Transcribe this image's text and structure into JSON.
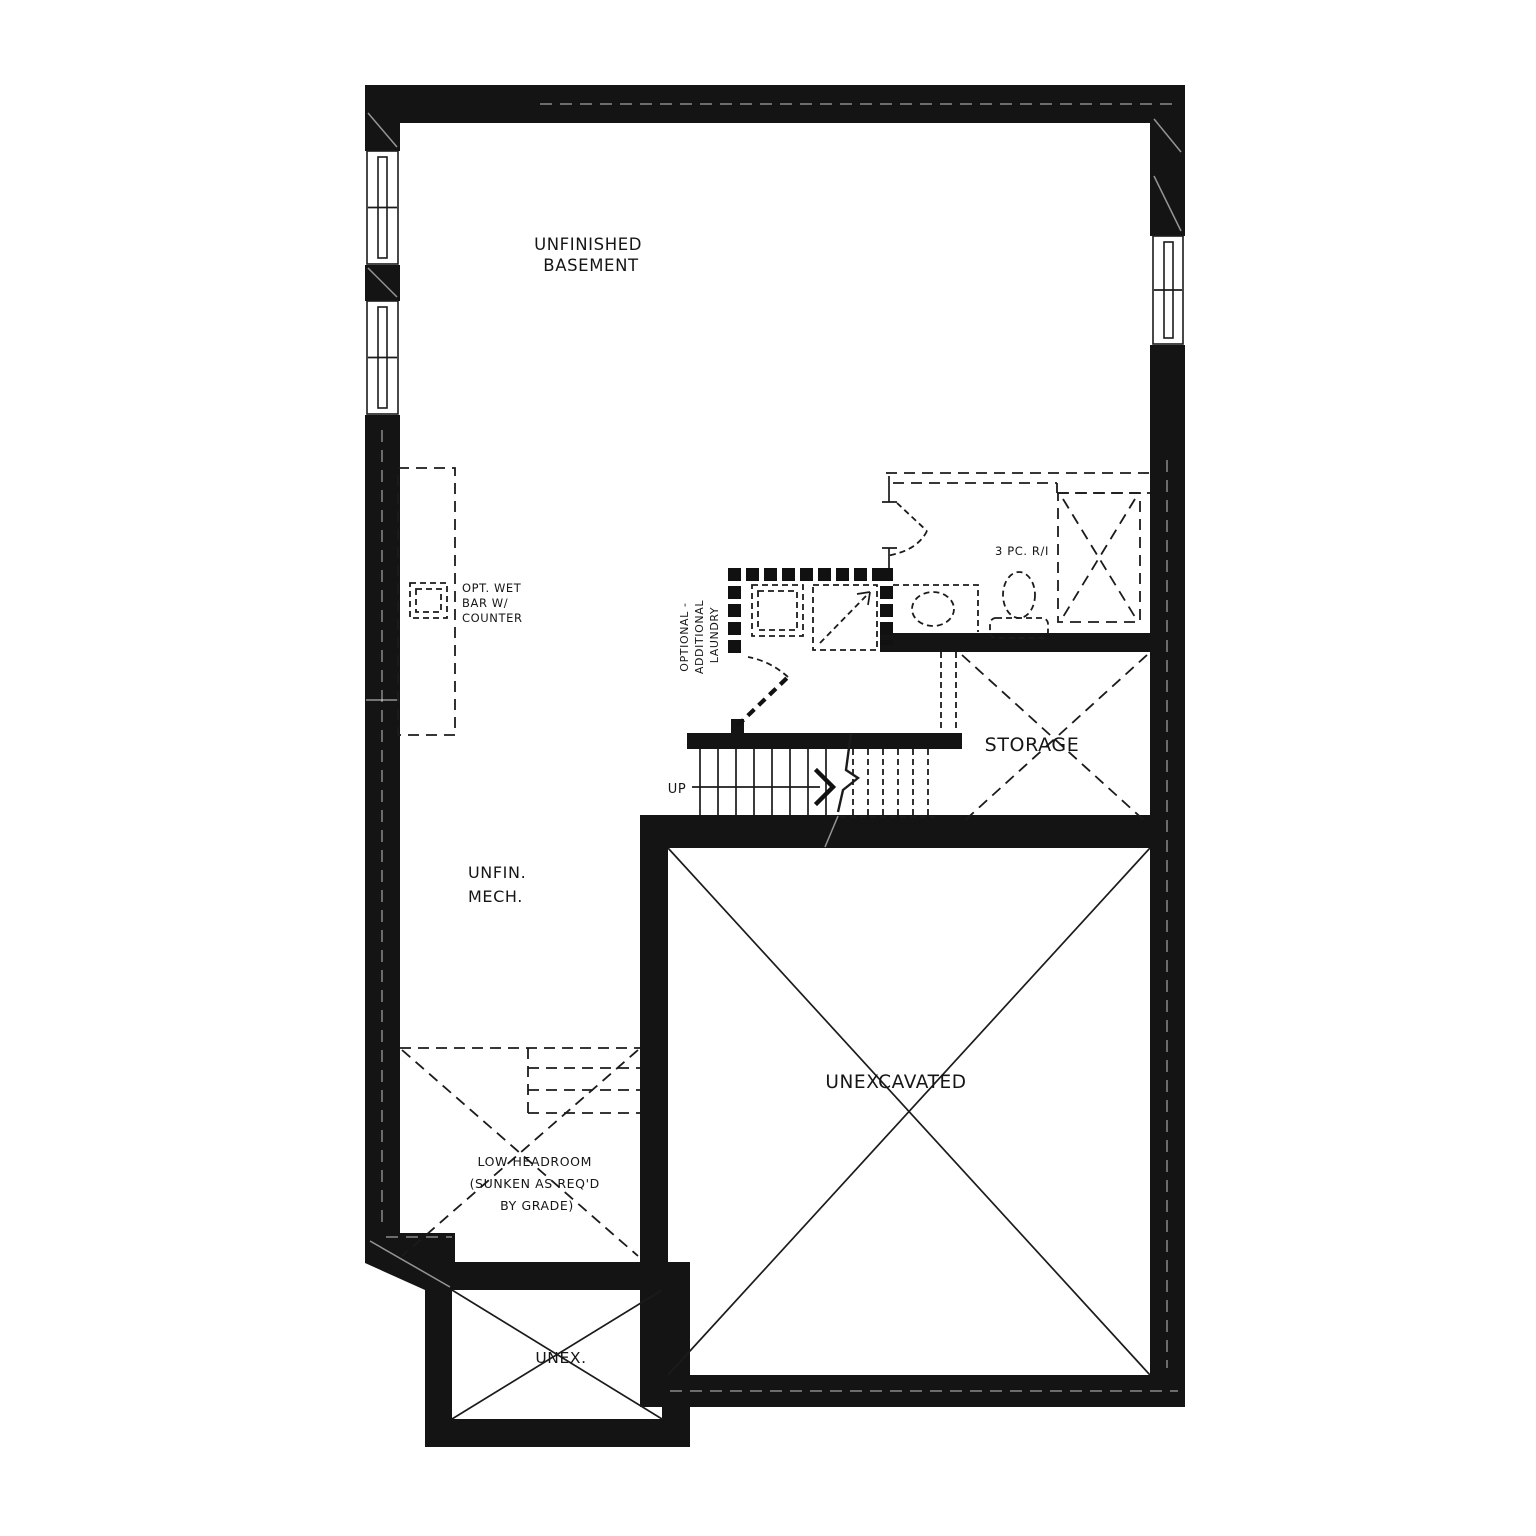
{
  "title": "Basement floor plan",
  "colors": {
    "wall": "#141414",
    "line": "#1b1b1b",
    "background": "#ffffff"
  },
  "labels": {
    "unfinished_basement": [
      "UNFINISHED",
      "BASEMENT"
    ],
    "wet_bar": [
      "OPT. WET",
      "BAR W/",
      "COUNTER"
    ],
    "optional_laundry": [
      "OPTIONAL -",
      "ADDITIONAL",
      "LAUNDRY"
    ],
    "bath_rough_in": "3 PC. R/I",
    "up": "UP",
    "storage": "STORAGE",
    "unfin_mech": [
      "UNFIN.",
      "MECH."
    ],
    "low_headroom": [
      "LOW HEADROOM",
      "(SUNKEN AS REQ'D",
      "BY GRADE)"
    ],
    "unexcavated": "UNEXCAVATED",
    "unex": "UNEX."
  }
}
